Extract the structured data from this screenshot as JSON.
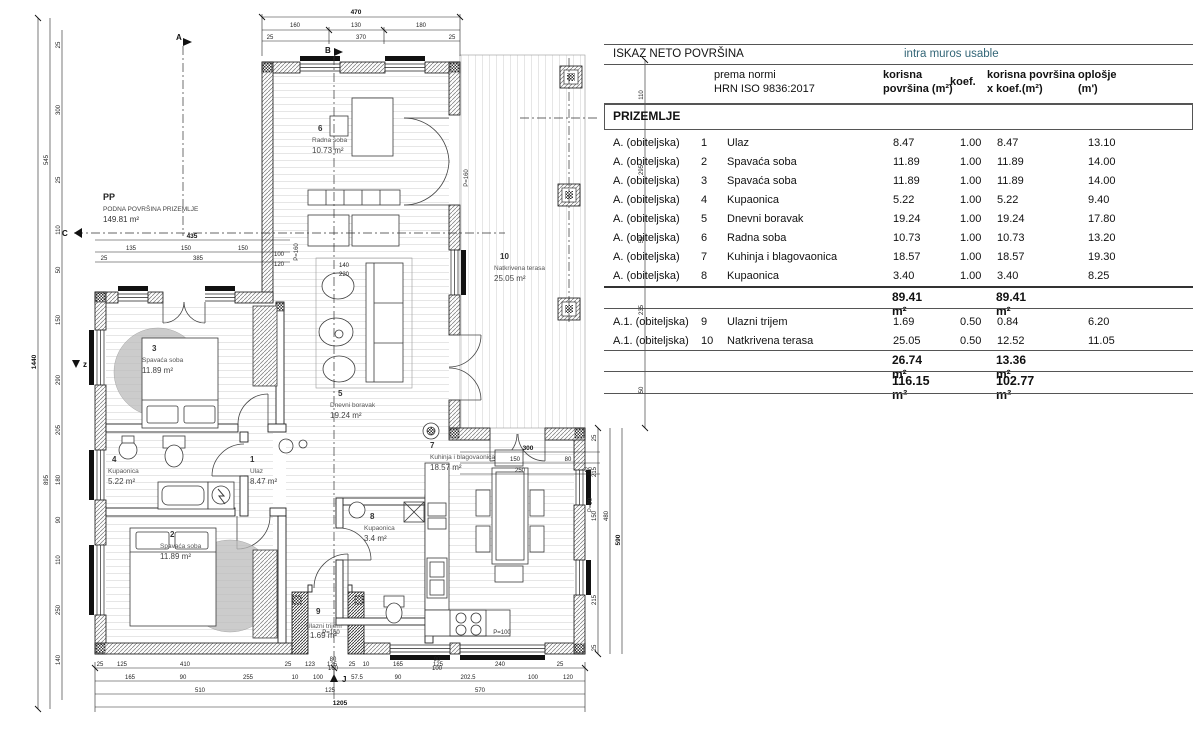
{
  "table": {
    "title": "ISKAZ NETO POVRŠINA",
    "subtitle": "intra muros usable",
    "subtitle_color": "#336677",
    "norm1": "prema normi",
    "norm2": "HRN ISO 9836:2017",
    "col_area1": "korisna",
    "col_area2": "površina (m²)",
    "col_koef": "koef.",
    "col_xkoef1": "korisna površina",
    "col_xkoef2": "x koef.(m²)",
    "col_opl1": "oplošje",
    "col_opl2": "(m')",
    "section": "PRIZEMLJE",
    "rows": [
      {
        "cat": "A. (obiteljska)",
        "num": "1",
        "name": "Ulaz",
        "area": "8.47",
        "koef": "1.00",
        "areakoef": "8.47",
        "oplosje": "13.10"
      },
      {
        "cat": "A. (obiteljska)",
        "num": "2",
        "name": "Spavaća soba",
        "area": "11.89",
        "koef": "1.00",
        "areakoef": "11.89",
        "oplosje": "14.00"
      },
      {
        "cat": "A. (obiteljska)",
        "num": "3",
        "name": "Spavaća soba",
        "area": "11.89",
        "koef": "1.00",
        "areakoef": "11.89",
        "oplosje": "14.00"
      },
      {
        "cat": "A. (obiteljska)",
        "num": "4",
        "name": "Kupaonica",
        "area": "5.22",
        "koef": "1.00",
        "areakoef": "5.22",
        "oplosje": "9.40"
      },
      {
        "cat": "A. (obiteljska)",
        "num": "5",
        "name": "Dnevni boravak",
        "area": "19.24",
        "koef": "1.00",
        "areakoef": "19.24",
        "oplosje": "17.80"
      },
      {
        "cat": "A. (obiteljska)",
        "num": "6",
        "name": "Radna soba",
        "area": "10.73",
        "koef": "1.00",
        "areakoef": "10.73",
        "oplosje": "13.20"
      },
      {
        "cat": "A. (obiteljska)",
        "num": "7",
        "name": "Kuhinja i blagovaonica",
        "area": "18.57",
        "koef": "1.00",
        "areakoef": "18.57",
        "oplosje": "19.30"
      },
      {
        "cat": "A. (obiteljska)",
        "num": "8",
        "name": "Kupaonica",
        "area": "3.40",
        "koef": "1.00",
        "areakoef": "3.40",
        "oplosje": "8.25"
      }
    ],
    "subtotal1": {
      "area": "89.41 m²",
      "areakoef": "89.41 m²"
    },
    "rows2": [
      {
        "cat": "A.1. (obiteljska)",
        "num": "9",
        "name": "Ulazni trijem",
        "area": "1.69",
        "koef": "0.50",
        "areakoef": "0.84",
        "oplosje": "6.20"
      },
      {
        "cat": "A.1. (obiteljska)",
        "num": "10",
        "name": "Natkrivena terasa",
        "area": "25.05",
        "koef": "0.50",
        "areakoef": "12.52",
        "oplosje": "11.05"
      }
    ],
    "subtotal2": {
      "area": "26.74 m²",
      "areakoef": "13.36 m²"
    },
    "total": {
      "area": "116.15 m²",
      "areakoef": "102.77 m²"
    }
  },
  "plan": {
    "pp": {
      "code": "PP",
      "line": "PODNA POVRŠINA PRIZEMLJE",
      "area": "149.81 m²"
    },
    "rooms": [
      {
        "num": "1",
        "name": "Ulaz",
        "area": "8.47 m²"
      },
      {
        "num": "2",
        "name": "Spavaća soba",
        "area": "11.89 m²"
      },
      {
        "num": "3",
        "name": "Spavaća soba",
        "area": "11.89 m²"
      },
      {
        "num": "4",
        "name": "Kupaonica",
        "area": "5.22 m²"
      },
      {
        "num": "5",
        "name": "Dnevni boravak",
        "area": "19.24 m²"
      },
      {
        "num": "6",
        "name": "Radna soba",
        "area": "10.73 m²"
      },
      {
        "num": "7",
        "name": "Kuhinja i blagovaonica",
        "area": "18.57 m²"
      },
      {
        "num": "8",
        "name": "Kupaonica",
        "area": "3.4 m²"
      },
      {
        "num": "9",
        "name": "Ulazni trijem",
        "area": "1.69 m²"
      },
      {
        "num": "10",
        "name": "Natkrivena terasa",
        "area": "25.05 m²"
      }
    ],
    "markers": {
      "a": "A",
      "b": "B",
      "c": "C",
      "z": "z",
      "j": "J"
    },
    "annotations": {
      "p1": "P=160",
      "p2": "P=160",
      "p3": "P=160",
      "p4": "P=100",
      "p5": "P=90"
    },
    "dims": {
      "top_total": "470",
      "top_seg": [
        "160",
        "130",
        "180"
      ],
      "top_inner": [
        "25",
        "370",
        "25"
      ],
      "ul_total": "435",
      "ul_seg": [
        "135",
        "150",
        "150"
      ],
      "ul_inner": [
        "25",
        "385",
        "100",
        "120"
      ],
      "left_total": "1440",
      "left_seg": [
        "545",
        "895"
      ],
      "left_inner": [
        "25",
        "300",
        "25",
        "110",
        "50",
        "150",
        "290",
        "205",
        "180",
        "90",
        "110",
        "250",
        "140"
      ],
      "bottom1": [
        "25",
        "125",
        "410",
        "25",
        "123",
        "125",
        "25",
        "10",
        "165",
        "125",
        "240",
        "25"
      ],
      "bottom2": [
        "165",
        "90",
        "255",
        "10",
        "100",
        "57.5",
        "90",
        "202.5",
        "100",
        "120"
      ],
      "bottom3": [
        "510",
        "125",
        "570"
      ],
      "bottom_total": "1205",
      "right_inner": [
        "25",
        "215",
        "150",
        "215",
        "25"
      ],
      "right_mid": "480",
      "right_total": "590",
      "ter_b1": "300",
      "ter_b2": [
        "150",
        "80"
      ],
      "ter_b3": [
        "250",
        "25"
      ],
      "ter_r": [
        "110",
        "295",
        "50",
        "235",
        "50"
      ],
      "pairs": [
        "140",
        "220",
        "80",
        "160",
        "90",
        "100"
      ]
    }
  }
}
